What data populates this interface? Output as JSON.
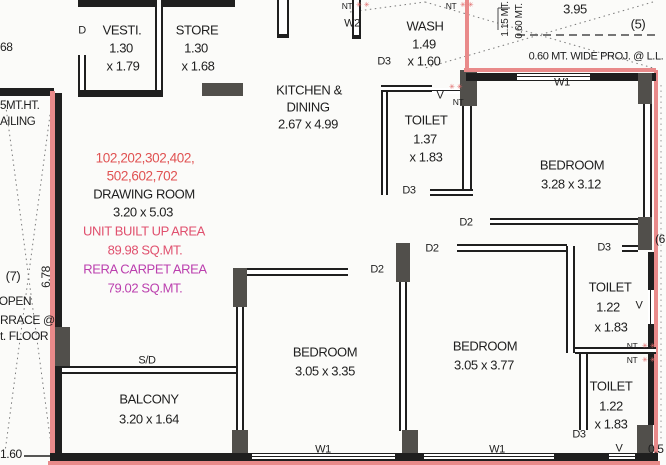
{
  "title": "Apartment unit floor plan",
  "rooms": {
    "vesti": {
      "name": "VESTI.",
      "d1": "1.30",
      "d2": "x 1.79"
    },
    "store": {
      "name": "STORE",
      "d1": "1.30",
      "d2": "x 1.68"
    },
    "kitchen": {
      "name": "KITCHEN &",
      "name2": "DINING",
      "dims": "2.67 x 4.99"
    },
    "wash": {
      "name": "WASH",
      "d1": "1.49",
      "d2": "x 1.60"
    },
    "toilet1": {
      "name": "TOILET",
      "d1": "1.37",
      "d2": "x 1.83"
    },
    "toilet3": {
      "name": "TOILET",
      "d1": "1.22",
      "d2": "x 1.83"
    },
    "toilet4": {
      "name": "TOILET",
      "d1": "1.22",
      "d2": "x 1.83"
    },
    "bedroom1": {
      "name": "BEDROOM",
      "dims": "3.05 x 3.35"
    },
    "bedroom2": {
      "name": "BEDROOM",
      "dims": "3.05 x 3.77"
    },
    "bedroom3": {
      "name": "BEDROOM",
      "dims": "3.28 x 3.12"
    },
    "balcony": {
      "name": "BALCONY",
      "dims": "3.20 x 1.64"
    },
    "drawing": {
      "u1": "102,202,302,402,",
      "u2": "502,602,702",
      "name": "DRAWING ROOM",
      "dims": "3.20 x 5.03",
      "b1": "UNIT BUILT UP AREA",
      "b2": "89.98 SQ.MT.",
      "c1": "RERA CARPET AREA",
      "c2": "79.02 SQ.MT."
    }
  },
  "marks": {
    "d": "D",
    "d2": "D2",
    "d3": "D3",
    "nt": "NT",
    "v": "V",
    "w1": "W1",
    "w2": "W2",
    "sd": "S/D"
  },
  "dims": {
    "left_height": "6.78",
    "bottom_left": "1.60",
    "top_right": "3.95",
    "proj": "0.60 MT. WIDE PROJ. @ L.L.",
    "mt115": "1.15 MT.",
    "mt060": "0.60 MT.",
    "right_frag": "0.5",
    "left_frag": "68"
  },
  "refs": {
    "r5": "(5)",
    "r6": "(6",
    "r7": "(7)"
  },
  "terrace": {
    "l1": "OPEN",
    "l2": "RRACE @",
    "l3": "t. FLOOR"
  },
  "railing": {
    "l1": "5MT.HT.",
    "l2": "AILING"
  },
  "colors": {
    "wall": "#1f1f1f",
    "pillar": "#514f4b",
    "boundary": "#e98a8a",
    "unit_numbers": "#e05252",
    "built_up": "#e0506e",
    "carpet": "#bb3fae"
  }
}
